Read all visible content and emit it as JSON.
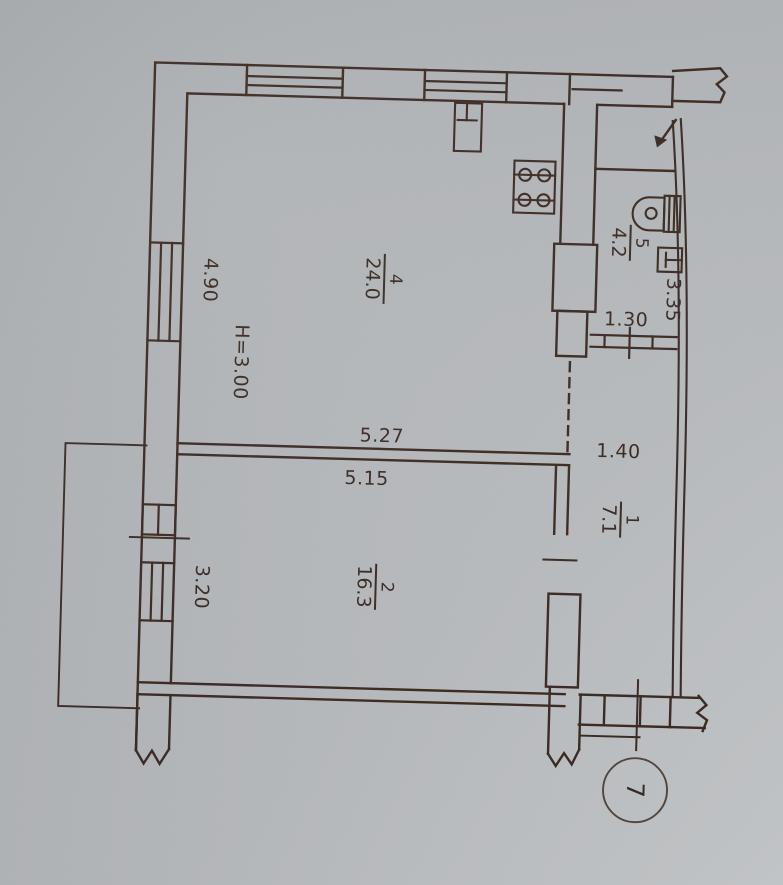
{
  "photo": {
    "paper_color_top": "#a7abae",
    "paper_color_bottom": "#cdd0d2",
    "ink_color": "#3a2a22"
  },
  "plan": {
    "rooms": [
      {
        "number": "4",
        "area": "24.0"
      },
      {
        "number": "5",
        "area": "4.2"
      },
      {
        "number": "1",
        "area": "7.1"
      },
      {
        "number": "2",
        "area": "16.3"
      }
    ],
    "dimensions": {
      "room4_width": "4.90",
      "room2_width": "3.20",
      "wall_top": "5.27",
      "wall_bottom": "5.15",
      "bath_door": "1.30",
      "hall_width": "1.40",
      "bath_length": "3.35"
    },
    "ceiling_height": "H=3.00",
    "sheet_number": "7"
  }
}
